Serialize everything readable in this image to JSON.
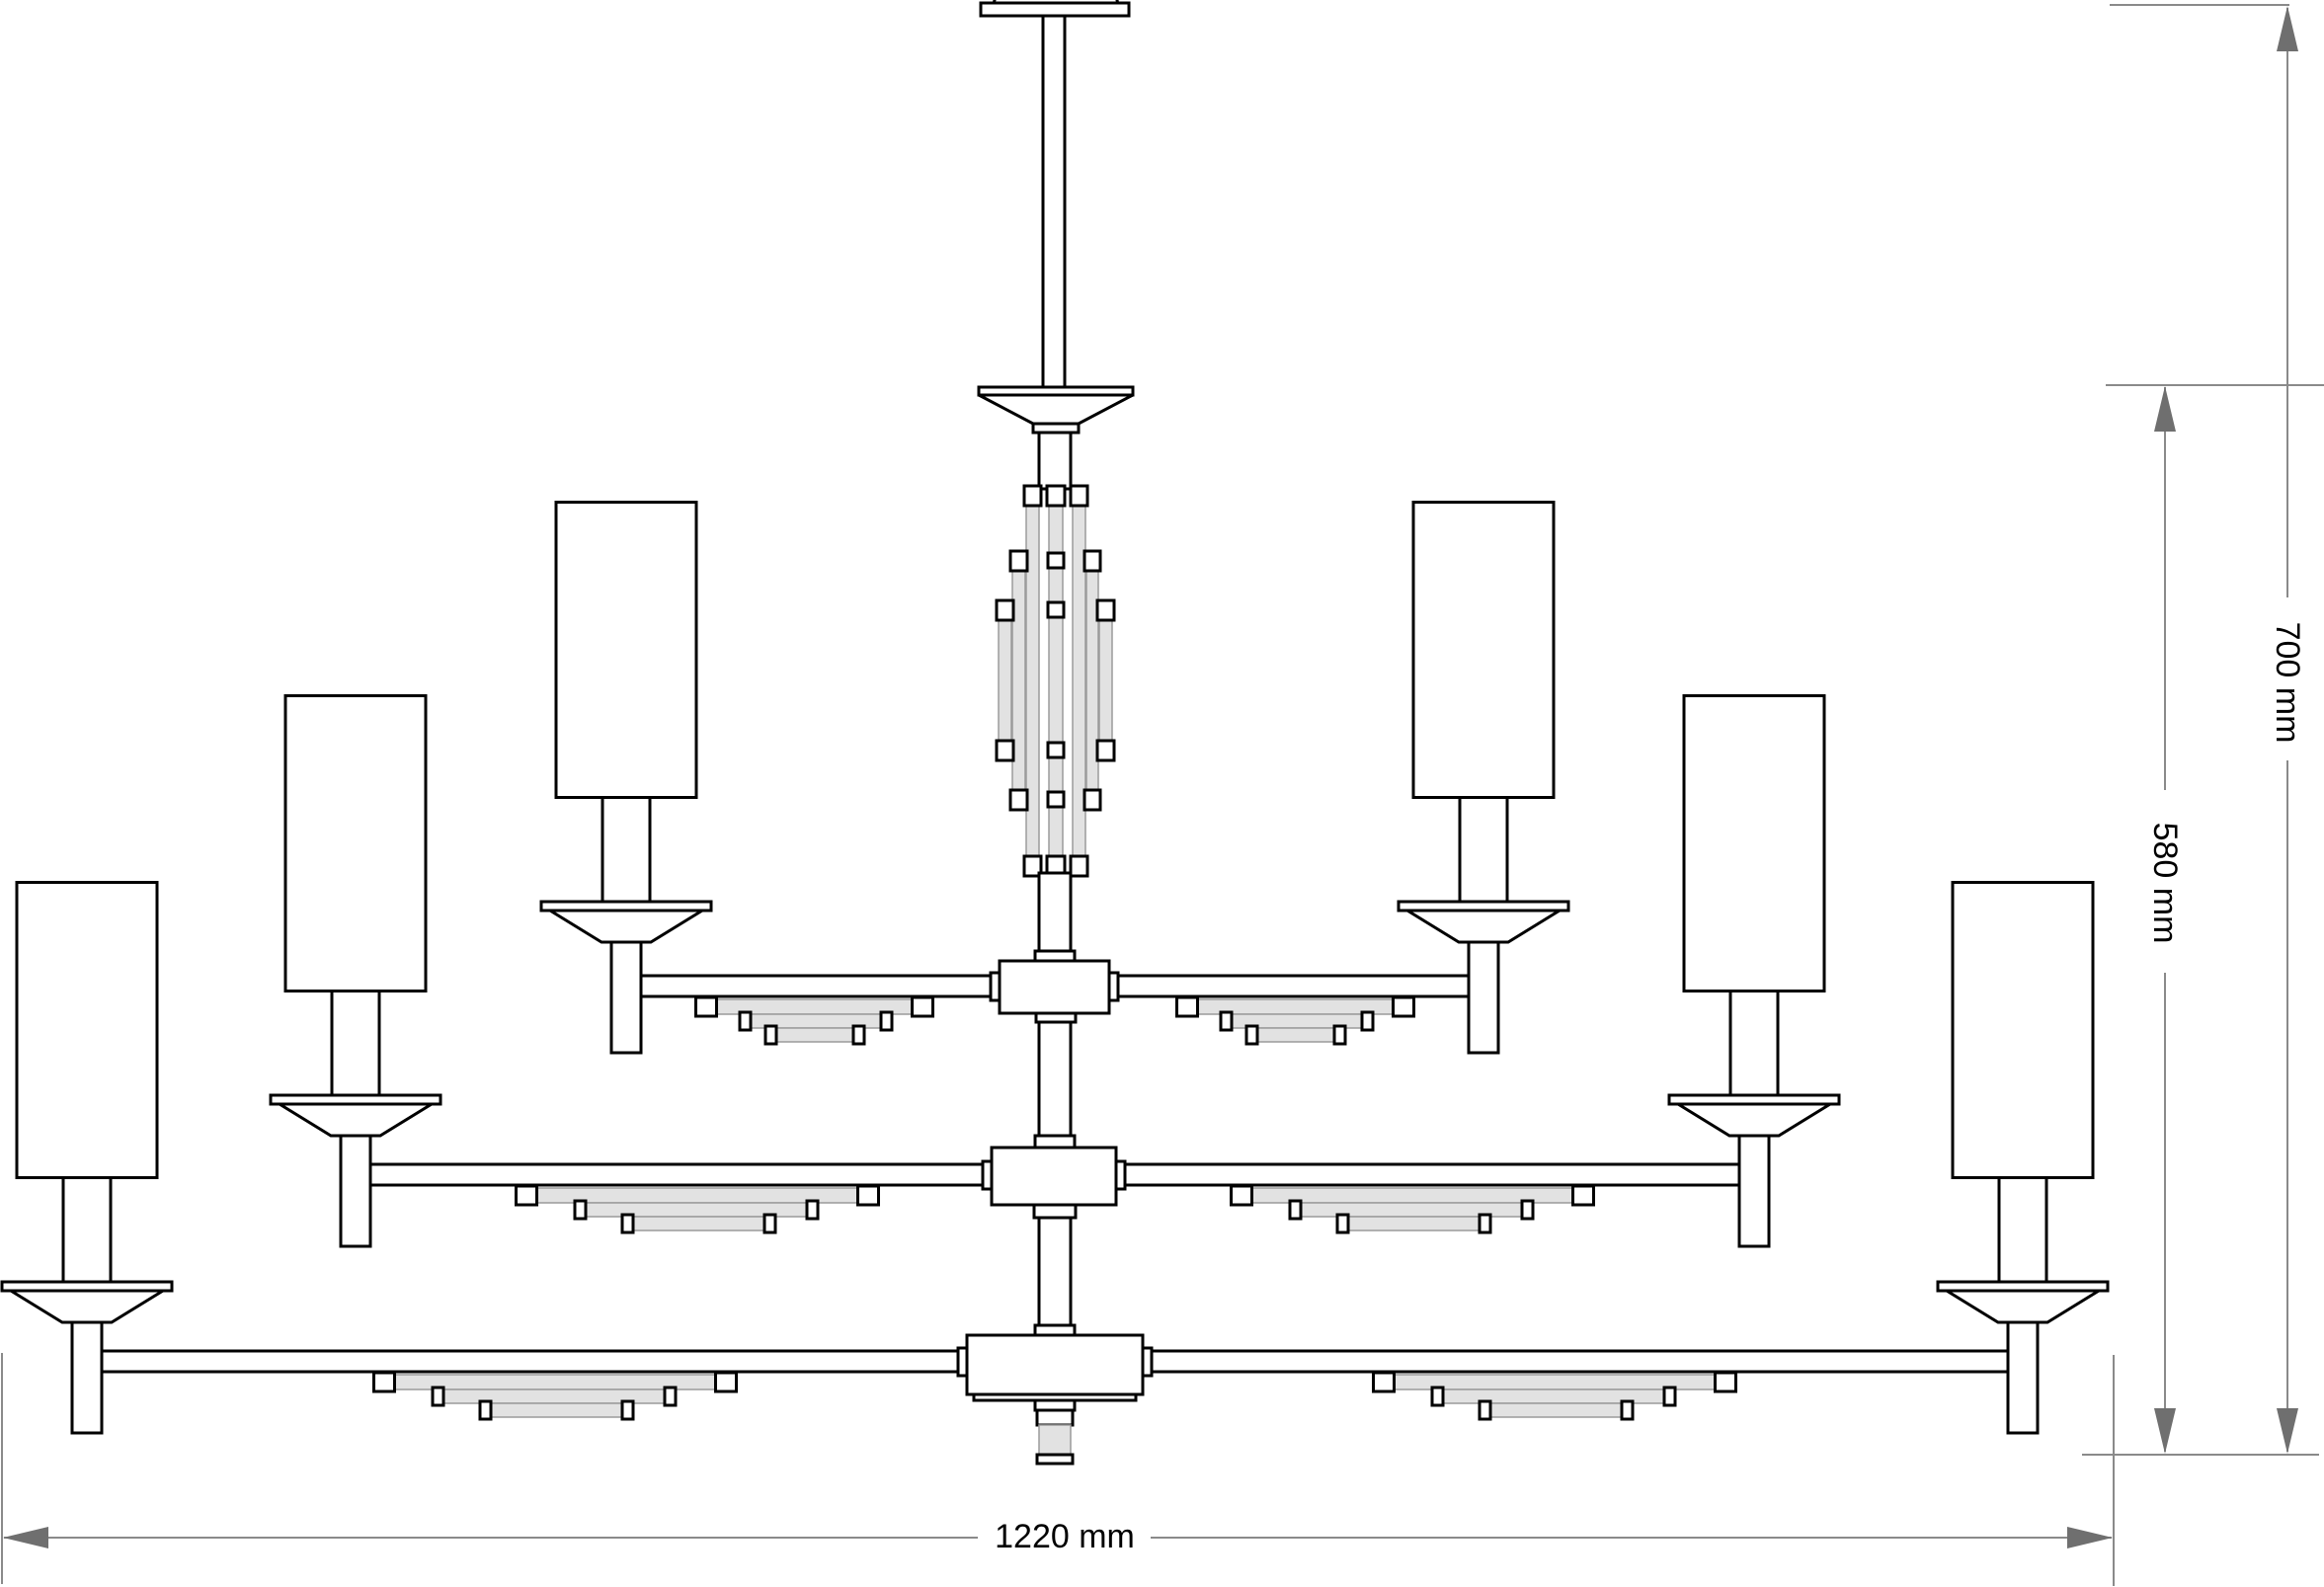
{
  "labels": {
    "width": "1220 mm",
    "height_total": "700 mm",
    "height_body": "580 mm"
  },
  "dimensions": {
    "width_mm": 1220,
    "height_total_mm": 700,
    "height_body_mm": 580,
    "unit": "mm"
  },
  "colors": {
    "outline": "#000000",
    "crystal_fill": "#e2e2e2",
    "crystal_edge": "#9b9b9b",
    "dim_line": "#8a8a8a",
    "dim_arrow": "#6f6f6f",
    "background": "#ffffff",
    "label_text": "#000000"
  }
}
